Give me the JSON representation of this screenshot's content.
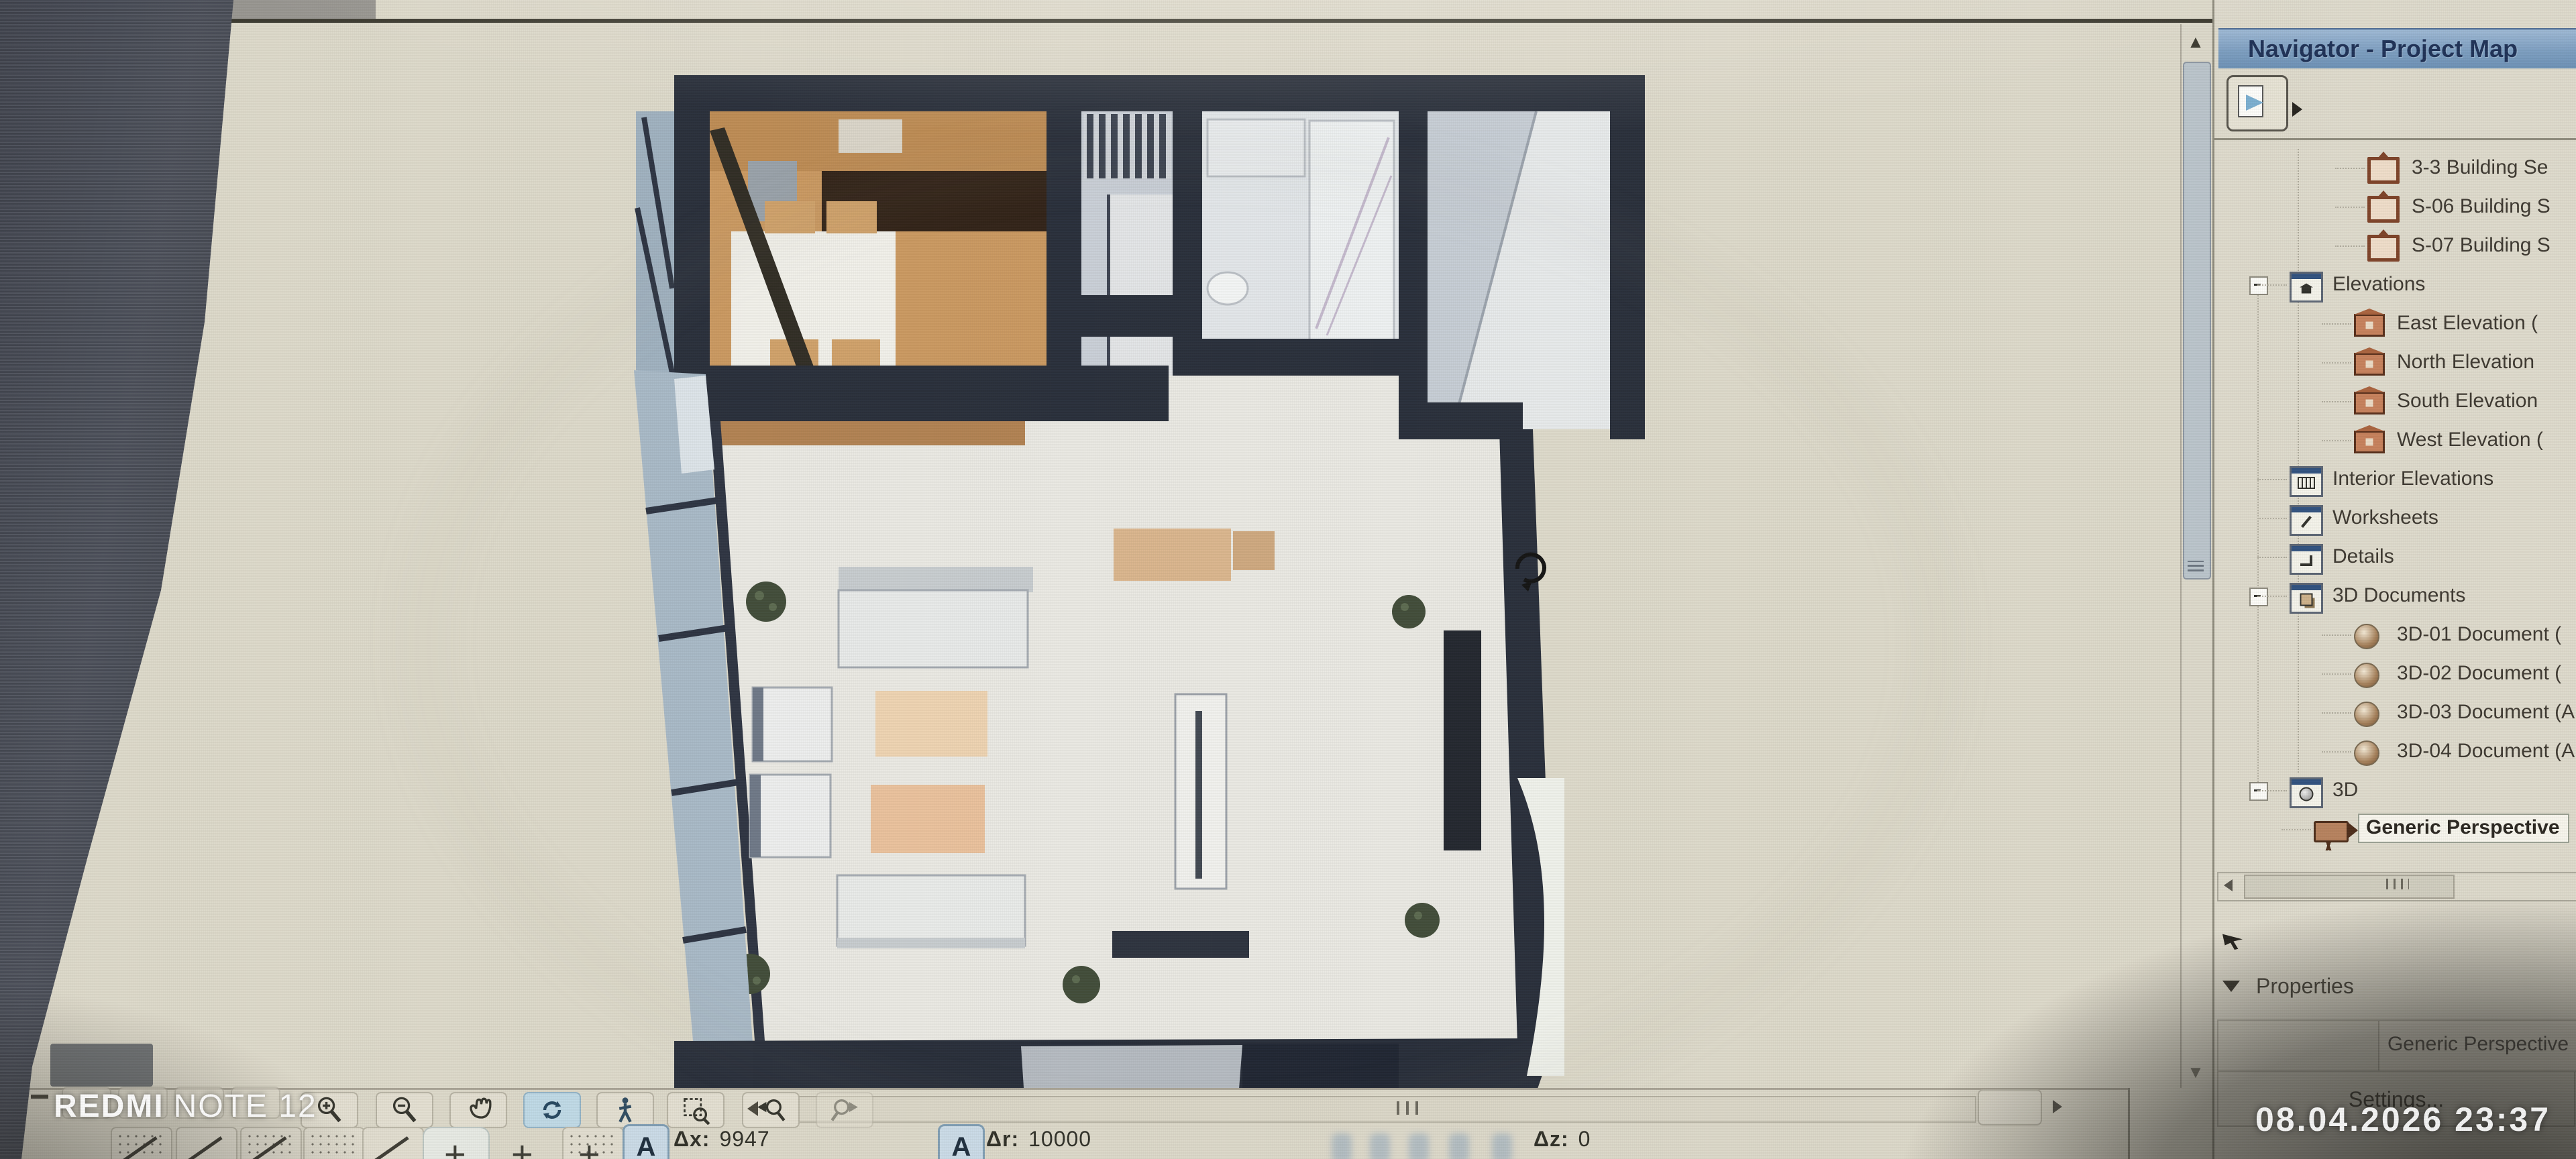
{
  "app": "ArchiCAD drawing window",
  "watermarks": {
    "device_bold": "REDMI",
    "device_rest": "NOTE 12",
    "datetime": "08.04.2026  23:37"
  },
  "navigator": {
    "title": "Navigator - Project Map",
    "tree": [
      {
        "label": "3-3 Building Se",
        "level": 3,
        "icon": "section",
        "selected": false,
        "expanded": null
      },
      {
        "label": "S-06 Building S",
        "level": 3,
        "icon": "section",
        "selected": false,
        "expanded": null
      },
      {
        "label": "S-07 Building S",
        "level": 3,
        "icon": "section",
        "selected": false,
        "expanded": null
      },
      {
        "label": "Elevations",
        "level": 2,
        "icon": "elevfolder",
        "selected": false,
        "expanded": true
      },
      {
        "label": "East Elevation (",
        "level": 3,
        "icon": "elev",
        "selected": false,
        "expanded": null
      },
      {
        "label": "North Elevation",
        "level": 3,
        "icon": "elev",
        "selected": false,
        "expanded": null
      },
      {
        "label": "South Elevation",
        "level": 3,
        "icon": "elev",
        "selected": false,
        "expanded": null
      },
      {
        "label": "West Elevation (",
        "level": 3,
        "icon": "elev",
        "selected": false,
        "expanded": null
      },
      {
        "label": "Interior Elevations",
        "level": 2,
        "icon": "interior",
        "selected": false,
        "expanded": null
      },
      {
        "label": "Worksheets",
        "level": 2,
        "icon": "worksheet",
        "selected": false,
        "expanded": null
      },
      {
        "label": "Details",
        "level": 2,
        "icon": "detail",
        "selected": false,
        "expanded": null
      },
      {
        "label": "3D Documents",
        "level": 2,
        "icon": "doc3dfolder",
        "selected": false,
        "expanded": true
      },
      {
        "label": "3D-01 Document (",
        "level": 3,
        "icon": "doc3d",
        "selected": false,
        "expanded": null
      },
      {
        "label": "3D-02 Document (",
        "level": 3,
        "icon": "doc3d",
        "selected": false,
        "expanded": null
      },
      {
        "label": "3D-03 Document (A",
        "level": 3,
        "icon": "doc3d",
        "selected": false,
        "expanded": null
      },
      {
        "label": "3D-04 Document (A",
        "level": 3,
        "icon": "doc3d",
        "selected": false,
        "expanded": null
      },
      {
        "label": "3D",
        "level": 2,
        "icon": "folder3d",
        "selected": false,
        "expanded": true
      },
      {
        "label": "Generic Perspective",
        "level": 3,
        "icon": "camera",
        "selected": true,
        "expanded": null
      }
    ],
    "properties_label": "Properties",
    "properties_value": "Generic Perspective",
    "settings_label": "Settings..."
  },
  "toolbar": {
    "buttons": [
      "zoom-in",
      "zoom-out",
      "pan",
      "orbit",
      "explore",
      "fit-in-window",
      "previous-view",
      "next-view"
    ],
    "active_button": "orbit"
  },
  "statusbar": {
    "dx_label": "Δx:",
    "dx_value": "9947",
    "dr_label": "Δr:",
    "dr_value": "10000",
    "dz_label": "Δz:",
    "dz_value": "0"
  },
  "view": {
    "name": "Generic Perspective",
    "type": "3D cutaway apartment plan",
    "accent_colors": {
      "wall": "#262c38",
      "wood_floor": "#c9975f",
      "title_bar": "#7b9dc0"
    }
  }
}
